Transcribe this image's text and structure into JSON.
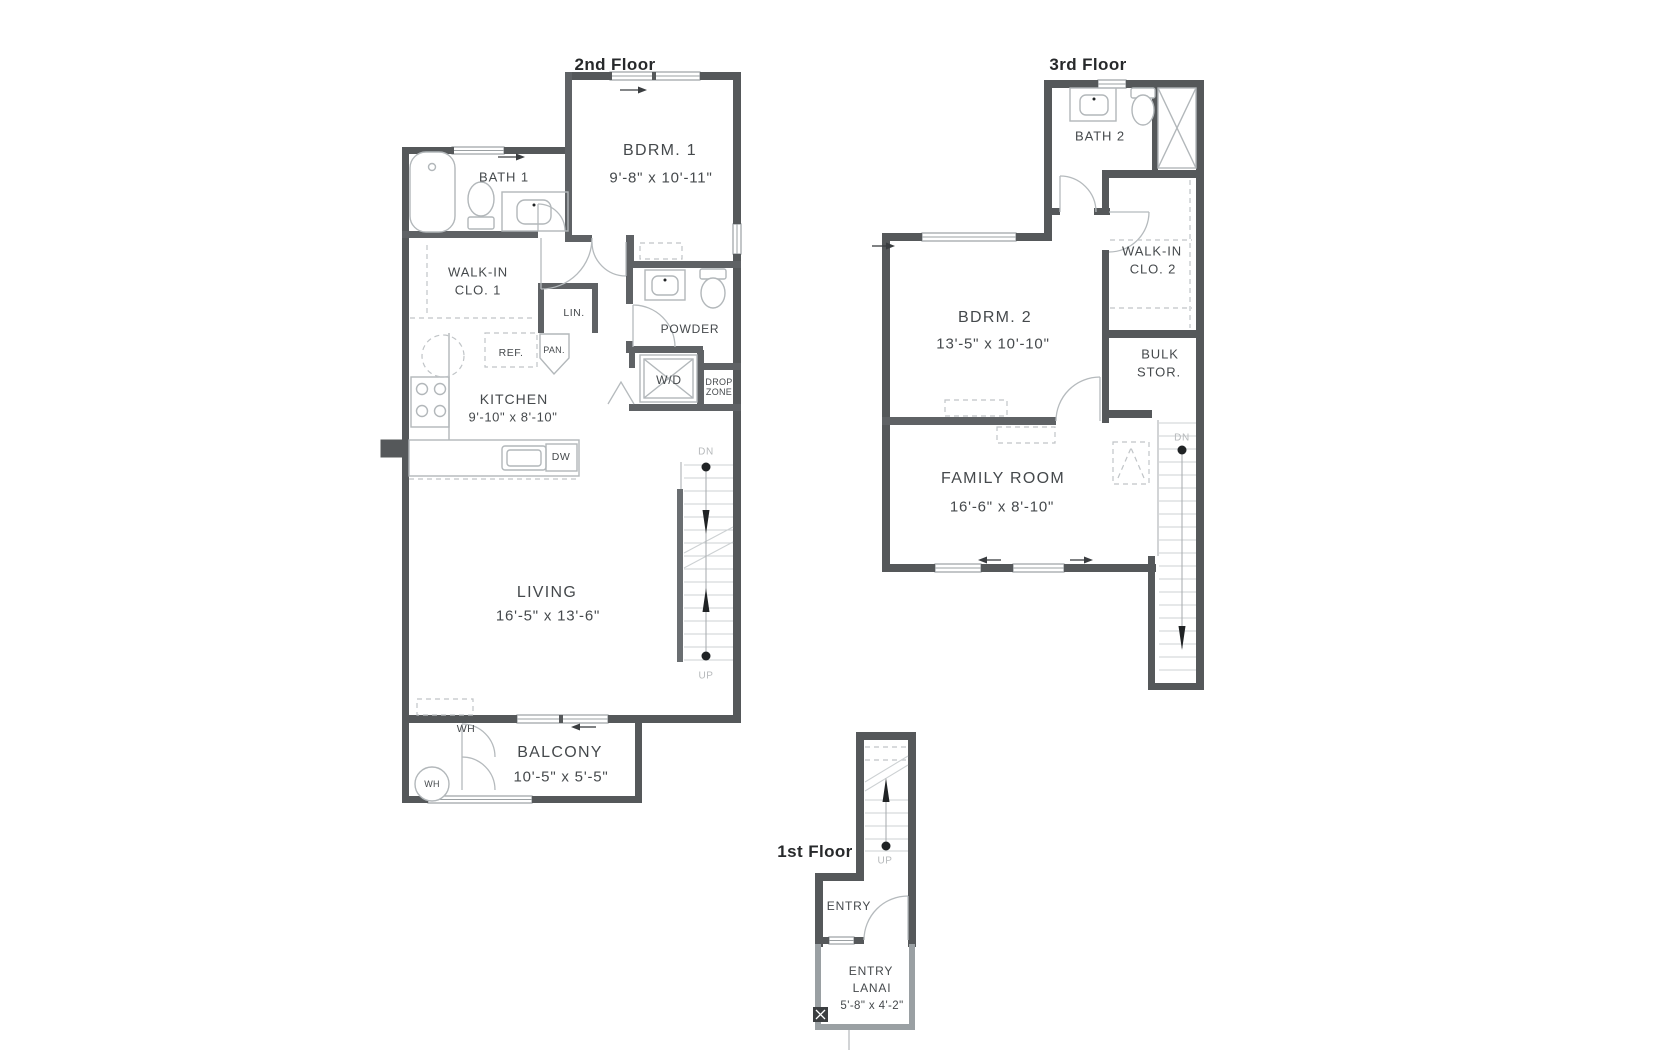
{
  "colors": {
    "wall": "#55585a",
    "interior_wall": "#5f6265",
    "light_wall": "#9aa0a3",
    "fixture_line": "#b2b7ba",
    "text_dark": "#45494c",
    "text_stair": "#b6b9bb"
  },
  "floor2": {
    "title": "2nd Floor",
    "bdrm1": {
      "name": "BDRM. 1",
      "dims": "9'-8\" x 10'-11\""
    },
    "bath1": {
      "name": "BATH 1"
    },
    "walkin1": {
      "line1": "WALK-IN",
      "line2": "CLO. 1"
    },
    "lin": {
      "name": "LIN."
    },
    "powder": {
      "name": "POWDER"
    },
    "ref": {
      "name": "REF."
    },
    "pan": {
      "name": "PAN."
    },
    "kitchen": {
      "name": "KITCHEN",
      "dims": "9'-10\" x 8'-10\""
    },
    "wd": {
      "name": "W/D"
    },
    "dropzone": {
      "line1": "DROP",
      "line2": "ZONE"
    },
    "dw": {
      "name": "DW"
    },
    "living": {
      "name": "LIVING",
      "dims": "16'-5\" x 13'-6\""
    },
    "wh_closet": {
      "name": "WH"
    },
    "wh_tank": {
      "name": "WH"
    },
    "balcony": {
      "name": "BALCONY",
      "dims": "10'-5\" x 5'-5\""
    },
    "stairs": {
      "dn": "DN",
      "up": "UP"
    }
  },
  "floor3": {
    "title": "3rd Floor",
    "bath2": {
      "name": "BATH 2"
    },
    "walkin2": {
      "line1": "WALK-IN",
      "line2": "CLO. 2"
    },
    "bdrm2": {
      "name": "BDRM. 2",
      "dims": "13'-5\" x 10'-10\""
    },
    "bulk": {
      "line1": "BULK",
      "line2": "STOR."
    },
    "family": {
      "name": "FAMILY ROOM",
      "dims": "16'-6\" x 8'-10\""
    },
    "stairs": {
      "dn": "DN"
    }
  },
  "floor1": {
    "title": "1st Floor",
    "entry": {
      "name": "ENTRY"
    },
    "lanai": {
      "line1": "ENTRY",
      "line2": "LANAI",
      "dims": "5'-8\" x 4'-2\""
    },
    "stairs": {
      "up": "UP"
    }
  }
}
